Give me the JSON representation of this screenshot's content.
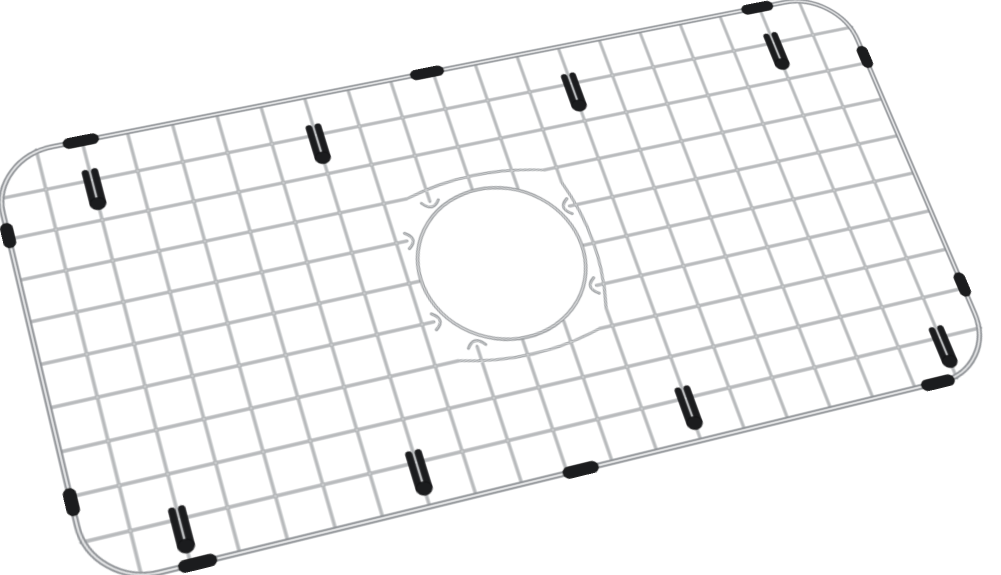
{
  "window": {
    "width": 1001,
    "height": 575,
    "background": "#ffffff"
  },
  "product_image": {
    "subject": "stainless-steel-kitchen-sink-bottom-grid-with-center-drain-hole",
    "style": {
      "background": "#ffffff",
      "wire_base": "#95989b",
      "wire_highlight": "#dadcdd",
      "frame_base": "#8f9296",
      "frame_highlight": "#e3e4e5",
      "ring_base": "#94979a",
      "ring_highlight": "#dfe0e1",
      "rubber": "#1b1c1e",
      "rubber_edge": "#0c0c0d"
    },
    "grid": {
      "columns": 20,
      "rows": 10,
      "cell_size": 44,
      "width": 880,
      "height": 440,
      "corner_radius": 60,
      "mesh_stroke": 2.8,
      "mesh_highlight_stroke": 1.0,
      "frame_stroke": 5.4,
      "frame_highlight_stroke": 1.9
    },
    "drain_hole": {
      "cx": 445,
      "cy": 219,
      "ring_radius": 81,
      "ring_stroke": 3.4,
      "ring_highlight_stroke": 1.2,
      "outer_clearance": 93,
      "inner_clearance": 83,
      "hook_cutoff": 43,
      "hook_half_width": 8.5,
      "hook_depth": 12,
      "graze_half_span": 70,
      "graze_bulge": 20
    },
    "perspective_matrix3d": [
      1.053216,
      -0.19064,
      0,
      0.000108385,
      0.214658,
      0.867411,
      0,
      -0.000186523,
      0,
      0,
      1,
      0,
      -10,
      159,
      0,
      1
    ],
    "rubber_feet": [
      {
        "col": 2,
        "row": 1
      },
      {
        "col": 7,
        "row": 1
      },
      {
        "col": 13,
        "row": 1
      },
      {
        "col": 18,
        "row": 1
      },
      {
        "col": 2,
        "row": 9
      },
      {
        "col": 7,
        "row": 9
      },
      {
        "col": 13,
        "row": 9
      },
      {
        "col": 19,
        "row": 9
      }
    ],
    "foot_shape": {
      "bar_width": 6,
      "bar_height": 40,
      "bar_gap": 3,
      "top_overhang": 12,
      "blob_rx": 7.5,
      "blob_ry": 6.5,
      "blob_drop": 26
    },
    "edge_bumpers": [
      {
        "edge": "top",
        "offset": 87
      },
      {
        "edge": "top",
        "offset": 434
      },
      {
        "edge": "top",
        "offset": 790
      },
      {
        "edge": "bottom",
        "offset": 94
      },
      {
        "edge": "bottom",
        "offset": 453
      },
      {
        "edge": "bottom",
        "offset": 816
      },
      {
        "edge": "left",
        "offset": 84
      },
      {
        "edge": "left",
        "offset": 357
      },
      {
        "edge": "right",
        "offset": 81
      },
      {
        "edge": "right",
        "offset": 348
      }
    ],
    "bumper_shape": {
      "length_horizontal": 34,
      "thickness_horizontal": 11,
      "length_vertical": 26,
      "thickness_vertical": 11,
      "radius": 5.5
    }
  }
}
